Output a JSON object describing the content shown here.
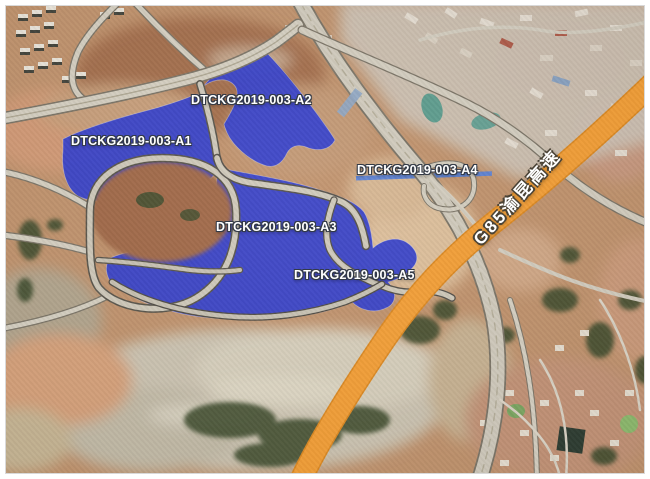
{
  "map": {
    "kind": "satellite-land-parcel-map",
    "parcels": [
      {
        "id": "A1",
        "label": "DTCKG2019-003-A1"
      },
      {
        "id": "A2",
        "label": "DTCKG2019-003-A2"
      },
      {
        "id": "A3",
        "label": "DTCKG2019-003-A3"
      },
      {
        "id": "A4",
        "label": "DTCKG2019-003-A4"
      },
      {
        "id": "A5",
        "label": "DTCKG2019-003-A5"
      }
    ],
    "highway": {
      "label": "G85渝昆高速"
    },
    "colors": {
      "parcel_fill": "#3843cb",
      "highway_orange": "#f5a037",
      "label_text": "#ffffff",
      "a4_strip": "#5b82d6"
    }
  }
}
